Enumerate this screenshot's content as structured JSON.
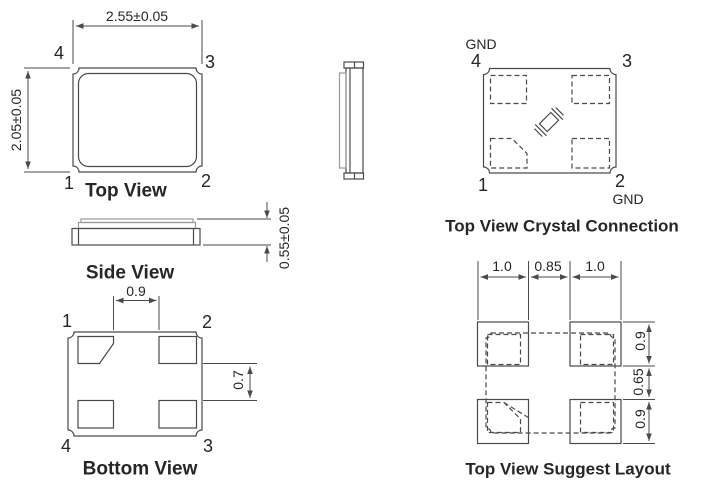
{
  "colors": {
    "line": "#4a4a4a",
    "line_light": "#9a9a9a",
    "text": "#262626",
    "background": "#ffffff"
  },
  "top_view": {
    "title": "Top View",
    "width_dim": "2.55±0.05",
    "height_dim": "2.05±0.05",
    "pin_top_left": "4",
    "pin_top_right": "3",
    "pin_bottom_left": "1",
    "pin_bottom_right": "2"
  },
  "side_view": {
    "title": "Side View",
    "height_dim": "0.55±0.05"
  },
  "bottom_view": {
    "title": "Bottom View",
    "pad_gap_horizontal": "0.9",
    "pad_gap_vertical": "0.7",
    "pin_top_left": "1",
    "pin_top_right": "2",
    "pin_bottom_left": "4",
    "pin_bottom_right": "3"
  },
  "crystal_connection": {
    "title": "Top View Crystal Connection",
    "gnd_top": "GND",
    "gnd_bottom": "GND",
    "pin_top_left": "4",
    "pin_top_right": "3",
    "pin_bottom_left": "1",
    "pin_bottom_right": "2"
  },
  "suggest_layout": {
    "title": "Top View Suggest Layout",
    "pad_width_left": "1.0",
    "pad_gap": "0.85",
    "pad_width_right": "1.0",
    "pad_height_top": "0.9",
    "vertical_gap": "0.65",
    "pad_height_bottom": "0.9"
  }
}
